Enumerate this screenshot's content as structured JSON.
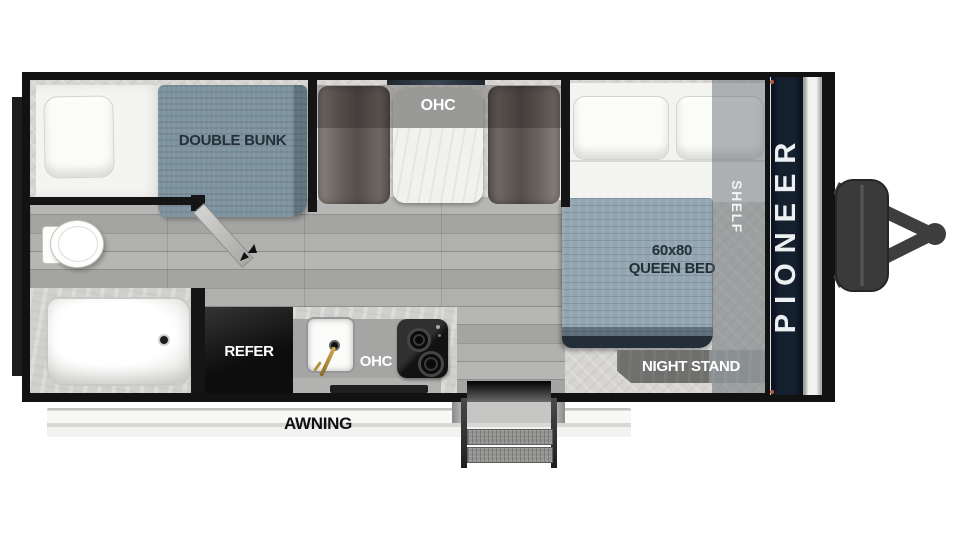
{
  "floorplan": {
    "bunk_label": "DOUBLE BUNK",
    "dinette_ohc_label": "OHC",
    "bed_size_label": "60x80",
    "bed_type_label": "QUEEN BED",
    "shelf_label": "SHELF",
    "night_stand_label": "NIGHT STAND",
    "refer_label": "REFER",
    "kitchen_ohc_label": "OHC",
    "awning_label": "AWNING"
  },
  "brand": {
    "name": "PIONEER"
  },
  "colors": {
    "walls": "#151515",
    "mattress_blue": "#7d939f",
    "blanket_blue": "#92a5b1",
    "bench_brown_gray": "#6a625e",
    "brand_navy": "#15202e",
    "brand_text": "#edf0f2",
    "label_dark": "#242f38",
    "counter_gray": "#a5a5a3",
    "marker_orange": "#b85c38"
  }
}
